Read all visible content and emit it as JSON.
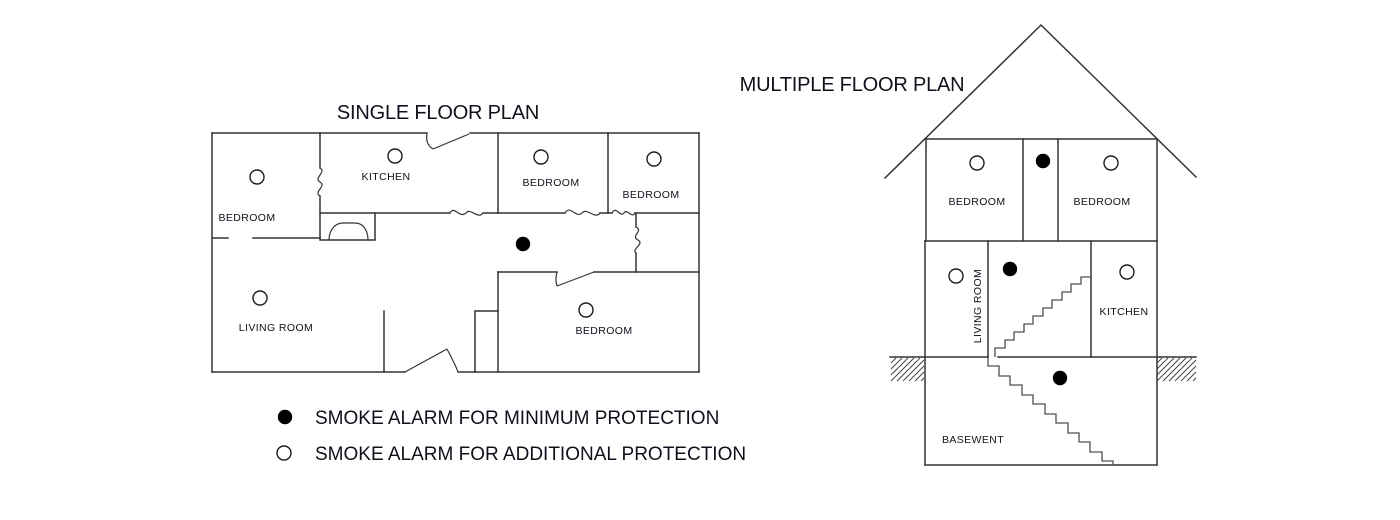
{
  "titles": {
    "single": "SINGLE FLOOR PLAN",
    "multiple": "MULTIPLE FLOOR PLAN"
  },
  "single_plan": {
    "rooms": {
      "bedroom_top_left": "BEDROOM",
      "kitchen": "KITCHEN",
      "bedroom_top_middle": "BEDROOM",
      "bedroom_top_right": "BEDROOM",
      "living_room": "LIVING ROOM",
      "bedroom_bottom_right": "BEDROOM"
    }
  },
  "multiple_plan": {
    "rooms": {
      "bedroom_left": "BEDROOM",
      "bedroom_right": "BEDROOM",
      "living_room": "LIVING ROOM",
      "kitchen": "KITCHEN",
      "basement": "BASEWENT"
    }
  },
  "legend": {
    "minimum": {
      "icon": "filled-circle",
      "label": "SMOKE ALARM FOR MINIMUM PROTECTION"
    },
    "additional": {
      "icon": "hollow-circle",
      "label": "SMOKE ALARM FOR ADDITIONAL PROTECTION"
    }
  },
  "colors": {
    "background": "#ffffff",
    "wall": "#333333",
    "stairs": "#4f4f4f",
    "text": "#10101c",
    "alarm": "#000000"
  }
}
